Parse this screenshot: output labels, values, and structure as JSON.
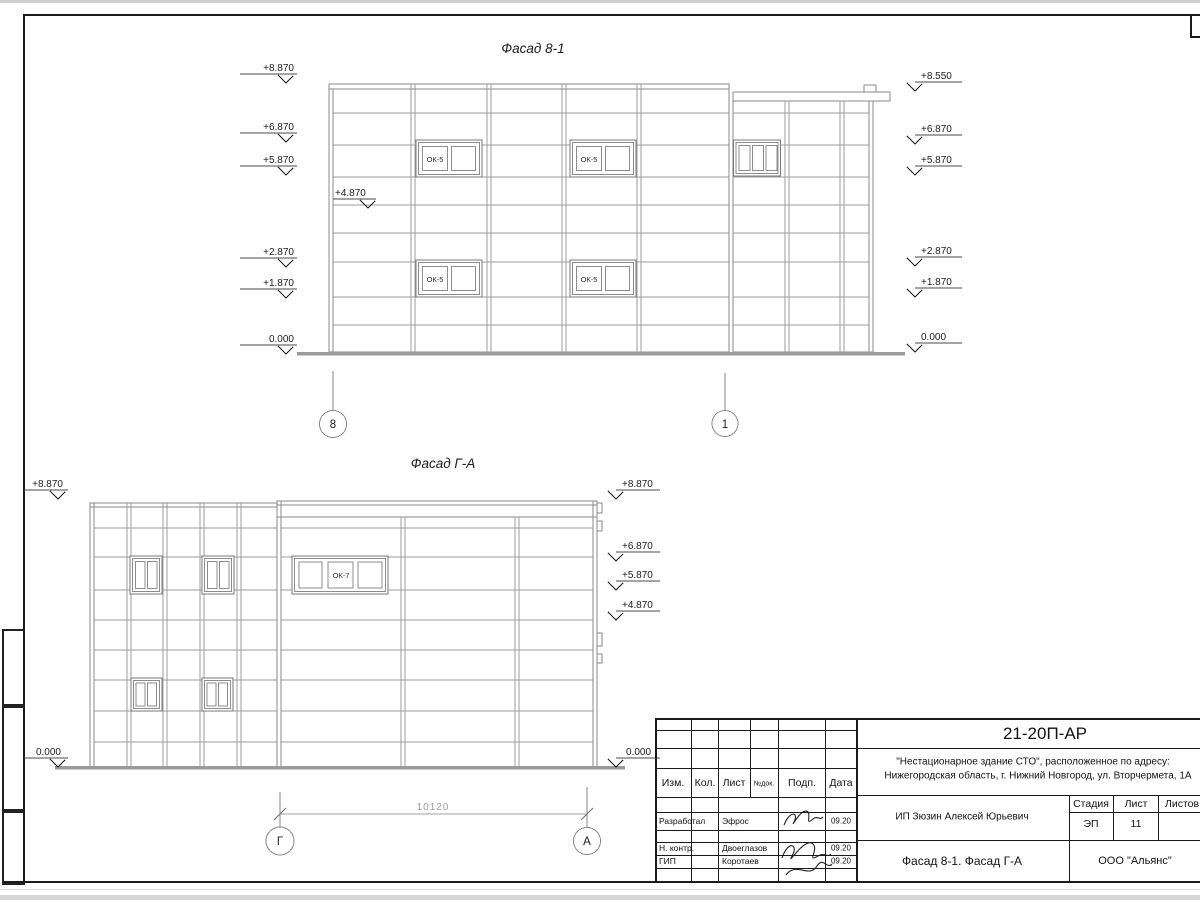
{
  "facade1": {
    "title": "Фасад 8-1",
    "window_label": "ОК-5",
    "axis_left": "8",
    "axis_right": "1",
    "mark_inner": "+4.870",
    "marks_left": [
      "+8.870",
      "+6.870",
      "+5.870",
      "+2.870",
      "+1.870",
      "0.000"
    ],
    "marks_right": [
      "+8.550",
      "+6.870",
      "+5.870",
      "+2.870",
      "+1.870",
      "0.000"
    ]
  },
  "facade2": {
    "title": "Фасад Г-А",
    "window_label": "ОК-7",
    "axis_left": "Г",
    "axis_right": "А",
    "dimension": "10120",
    "marks_left": [
      "+8.870",
      "0.000"
    ],
    "marks_right": [
      "+8.870",
      "+6.870",
      "+5.870",
      "+4.870",
      "0.000"
    ]
  },
  "titleblock": {
    "doc_number": "21-20П-АР",
    "project_line1": "\"Нестационарное здание СТО\", расположенное по адресу:",
    "project_line2": "Нижегородская область, г. Нижний Новгород, ул. Вторчермета, 1А",
    "client": "ИП Зюзин Алексей Юрьевич",
    "sheet_title": "Фасад 8-1. Фасад Г-А",
    "company": "ООО \"Альянс\"",
    "stage_label": "Стадия",
    "stage_value": "ЭП",
    "list_label": "Лист",
    "list_value": "11",
    "listov_label": "Листов",
    "header": {
      "izm": "Изм.",
      "kol": "Кол.",
      "list": "Лист",
      "ndok": "№док.",
      "podp": "Подп.",
      "data": "Дата"
    },
    "rows": [
      {
        "role": "Разработал",
        "name": "Эфрос",
        "date": "09.20"
      },
      {
        "role": "Н. контр.",
        "name": "Двоеглазов",
        "date": "09.20"
      },
      {
        "role": "ГИП",
        "name": "Коротаев",
        "date": "09.20"
      }
    ]
  }
}
